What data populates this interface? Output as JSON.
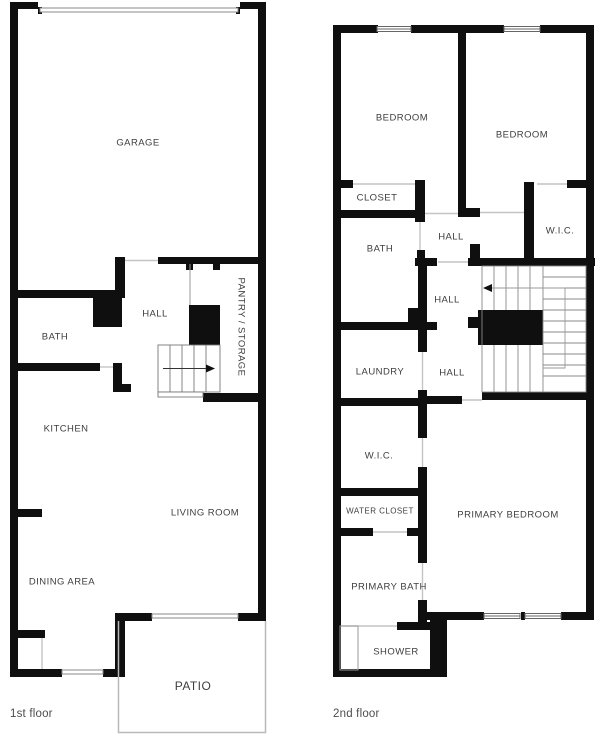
{
  "colors": {
    "wall": "#0f0f0f",
    "door_line": "#c4c4c4",
    "tread_line": "#777777",
    "patio_line": "#b9b9b9",
    "label_text": "#3e3e3e",
    "caption_text": "#4d4d4d"
  },
  "floor1": {
    "caption": "1st floor",
    "rooms": [
      {
        "id": "garage",
        "label": "GARAGE",
        "x": 138,
        "y": 143
      },
      {
        "id": "bath-1f",
        "label": "BATH",
        "x": 55,
        "y": 337
      },
      {
        "id": "hall-1f",
        "label": "HALL",
        "x": 155,
        "y": 314
      },
      {
        "id": "pantry-storage",
        "label": "PANTRY / STORAGE",
        "x": 241,
        "y": 327,
        "rotate": 90
      },
      {
        "id": "kitchen",
        "label": "KITCHEN",
        "x": 66,
        "y": 429
      },
      {
        "id": "living-room",
        "label": "LIVING ROOM",
        "x": 205,
        "y": 513
      },
      {
        "id": "dining-area",
        "label": "DINING AREA",
        "x": 62,
        "y": 582
      },
      {
        "id": "patio",
        "label": "PATIO",
        "x": 193,
        "y": 686,
        "size": 12
      }
    ]
  },
  "floor2": {
    "caption": "2nd floor",
    "rooms": [
      {
        "id": "bedroom-left",
        "label": "BEDROOM",
        "x": 402,
        "y": 118
      },
      {
        "id": "bedroom-right",
        "label": "BEDROOM",
        "x": 522,
        "y": 135
      },
      {
        "id": "closet",
        "label": "CLOSET",
        "x": 377,
        "y": 198
      },
      {
        "id": "bath-2f",
        "label": "BATH",
        "x": 380,
        "y": 249
      },
      {
        "id": "hall-upper",
        "label": "HALL",
        "x": 451,
        "y": 237
      },
      {
        "id": "wic-right",
        "label": "W.I.C.",
        "x": 560,
        "y": 231
      },
      {
        "id": "hall-middle",
        "label": "HALL",
        "x": 447,
        "y": 300
      },
      {
        "id": "laundry",
        "label": "LAUNDRY",
        "x": 380,
        "y": 372
      },
      {
        "id": "hall-lower",
        "label": "HALL",
        "x": 452,
        "y": 373
      },
      {
        "id": "wic-left",
        "label": "W.I.C.",
        "x": 379,
        "y": 456
      },
      {
        "id": "water-closet",
        "label": "WATER CLOSET",
        "x": 380,
        "y": 511,
        "size": 8
      },
      {
        "id": "primary-bedroom",
        "label": "PRIMARY BEDROOM",
        "x": 508,
        "y": 515
      },
      {
        "id": "primary-bath",
        "label": "PRIMARY BATH",
        "x": 389,
        "y": 587
      },
      {
        "id": "shower",
        "label": "SHOWER",
        "x": 396,
        "y": 652
      }
    ]
  }
}
